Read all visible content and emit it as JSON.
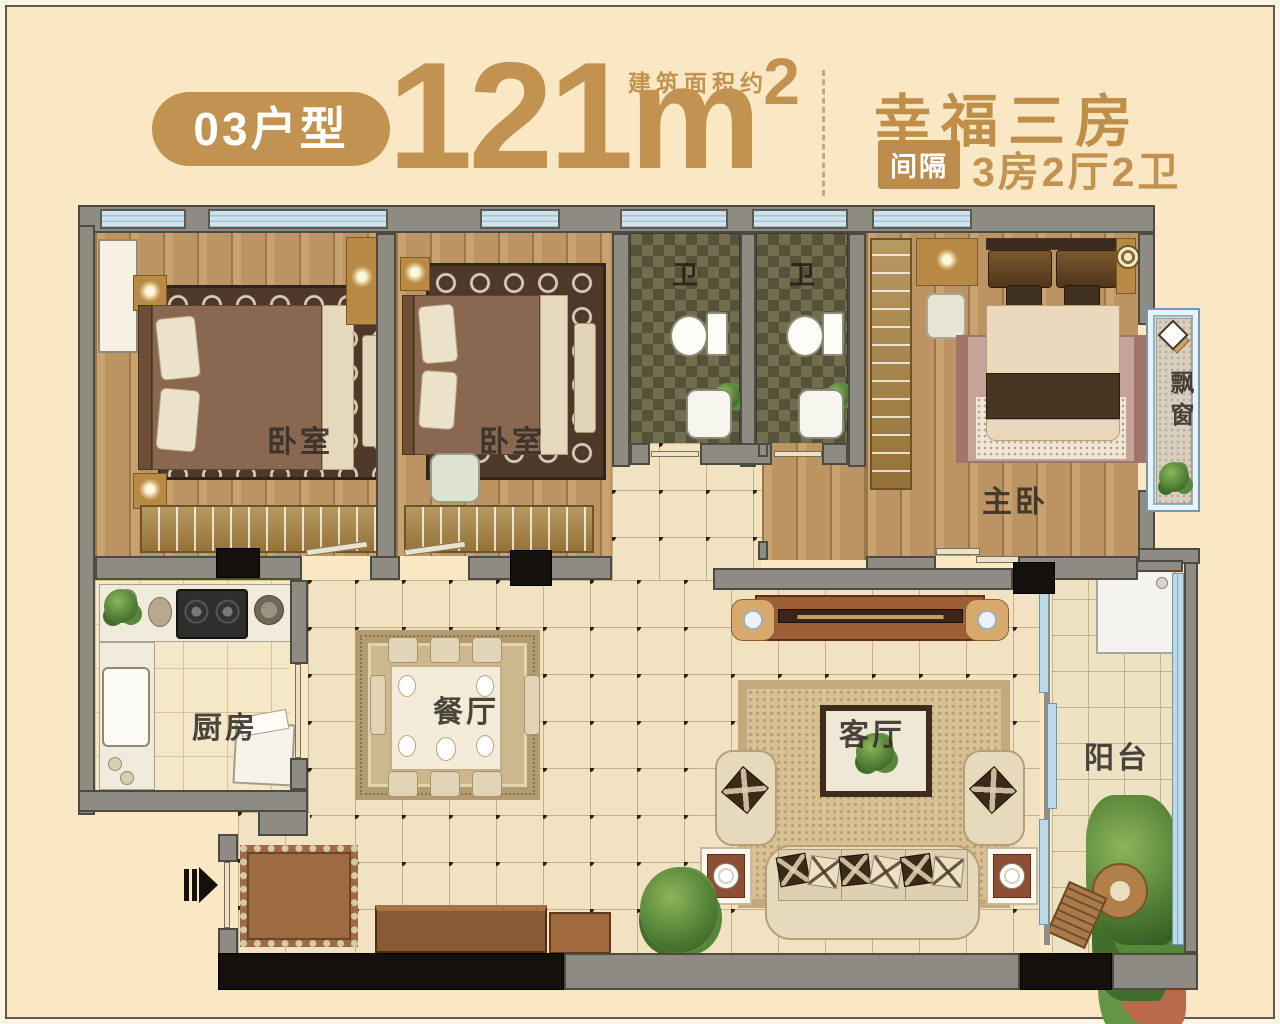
{
  "header": {
    "unit_badge": "03户型",
    "area_value": "121",
    "area_unit": "m",
    "area_sup": "2",
    "area_note": "建筑面积约",
    "plan_name": "幸福三房",
    "layout_badge": "间隔",
    "layout_text": "3房2厅2卫"
  },
  "colors": {
    "accent_gold": "#c29350",
    "background_cream": "#fae8c5",
    "wall_gray": "#8d8b82",
    "column_black": "#14110c",
    "window_blue": "#cfe3ef",
    "wood_floor": "#c59c66",
    "hall_tile": "#f1e3c1",
    "bath_tile": "#716e4f"
  },
  "rooms": {
    "bedroom1": "卧室",
    "bedroom2": "卧室",
    "bath1": "卫",
    "bath2": "卫",
    "master_bedroom": "主卧",
    "bay_window": "飘窗",
    "kitchen": "厨房",
    "dining": "餐厅",
    "living": "客厅",
    "balcony": "阳台"
  }
}
